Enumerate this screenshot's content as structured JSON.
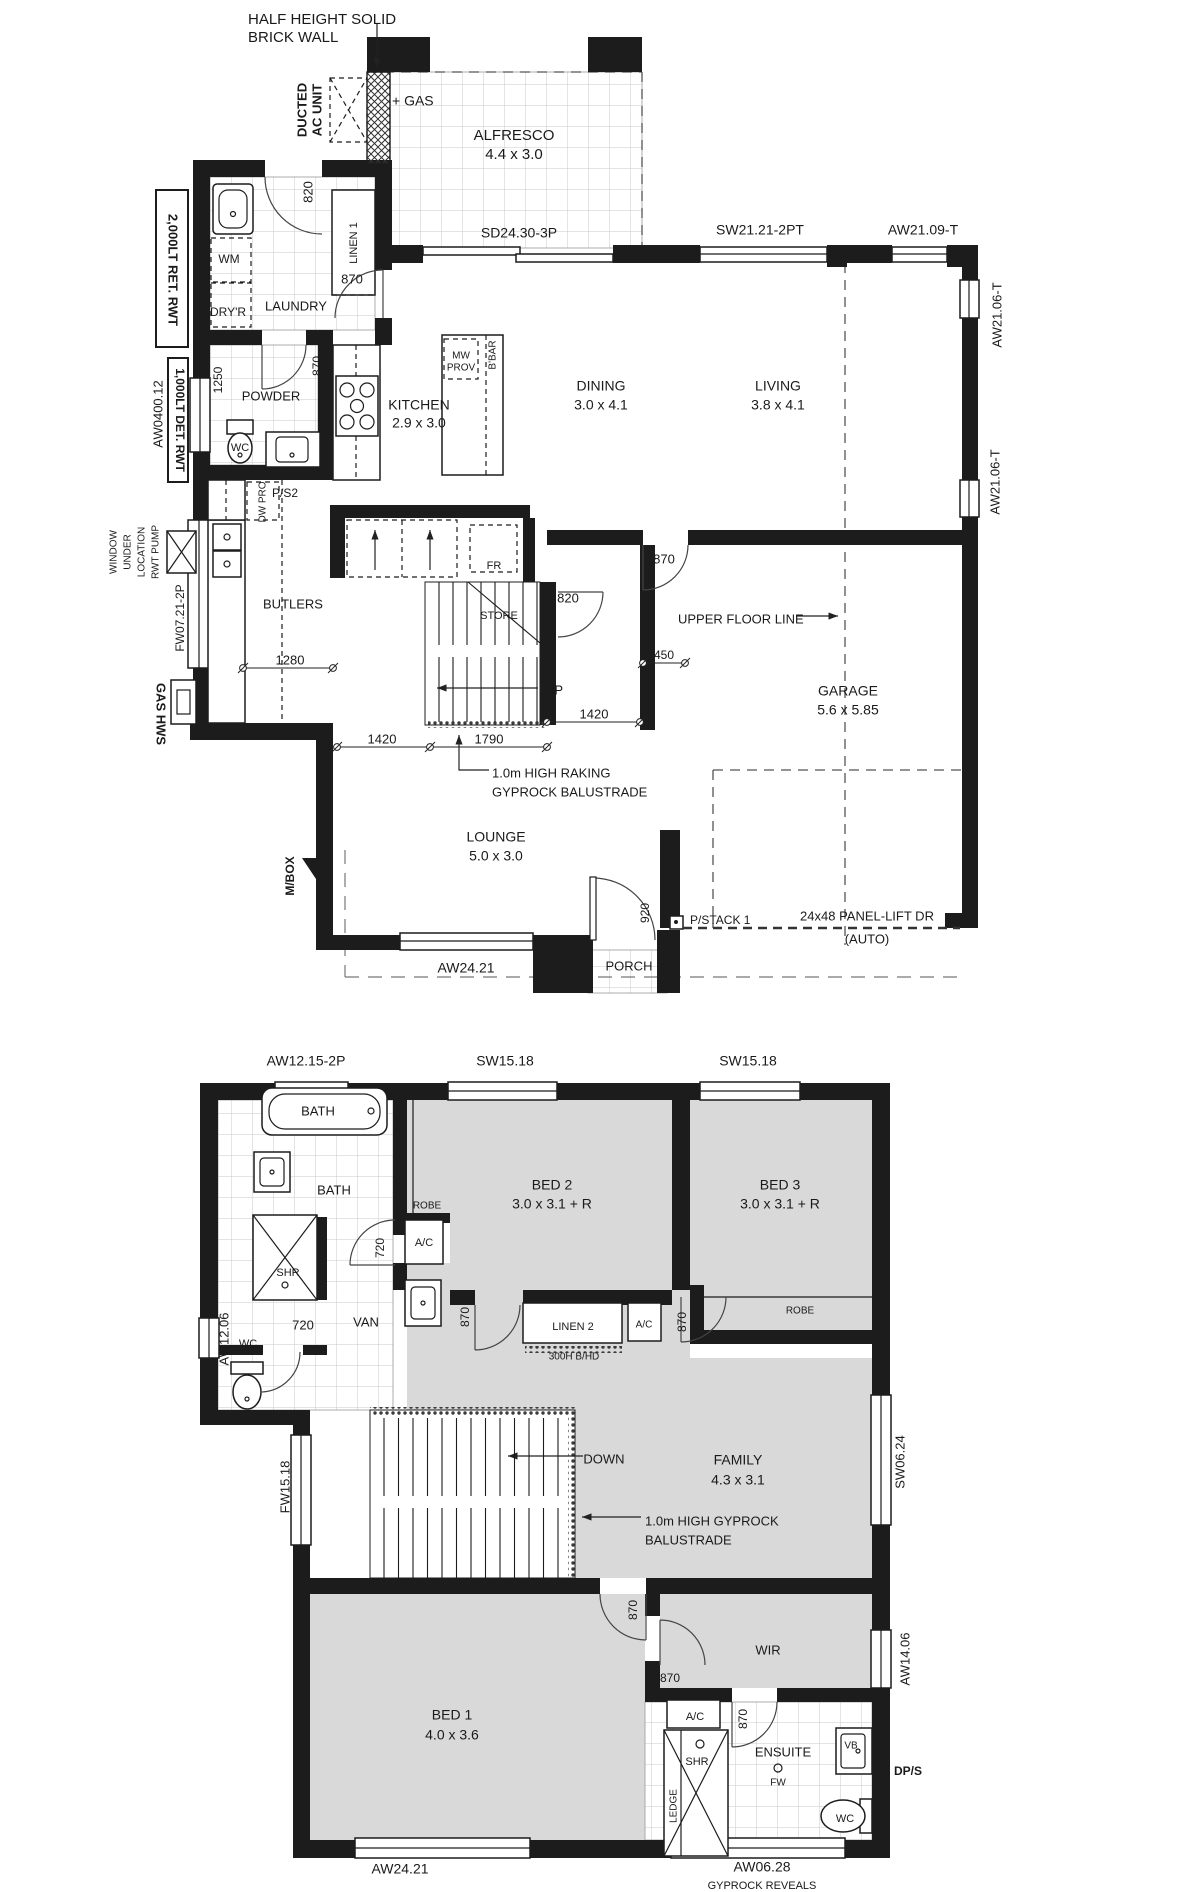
{
  "colors": {
    "wall": "#1c1c1c",
    "carpet": "#d9d9d9",
    "tile_line": "#c9c9c9",
    "paper": "#ffffff"
  },
  "ground_floor": {
    "labels": [
      {
        "t": "HALF HEIGHT SOLID",
        "x": 248,
        "y": 20,
        "a": "start",
        "s": 15
      },
      {
        "t": "BRICK WALL",
        "x": 248,
        "y": 38,
        "a": "start",
        "s": 15
      },
      {
        "t": "DUCTED",
        "x": 303,
        "y": 110,
        "r": -90,
        "s": 13,
        "b": 1
      },
      {
        "t": "AC UNIT",
        "x": 318,
        "y": 110,
        "r": -90,
        "s": 13,
        "b": 1
      },
      {
        "t": "+ GAS",
        "x": 392,
        "y": 102,
        "a": "start",
        "s": 14
      },
      {
        "t": "ALFRESCO",
        "x": 514,
        "y": 136,
        "s": 15
      },
      {
        "t": "4.4 x 3.0",
        "x": 514,
        "y": 155,
        "s": 15
      },
      {
        "t": "SD24.30-3P",
        "x": 519,
        "y": 234,
        "s": 14
      },
      {
        "t": "SW21.21-2PT",
        "x": 760,
        "y": 231,
        "s": 14
      },
      {
        "t": "AW21.09-T",
        "x": 923,
        "y": 231,
        "s": 14
      },
      {
        "t": "AW21.06-T",
        "x": 998,
        "y": 315,
        "r": -90,
        "s": 13
      },
      {
        "t": "AW21.06-T",
        "x": 996,
        "y": 482,
        "r": -90,
        "s": 13
      },
      {
        "t": "2,000LT RET. RWT",
        "x": 172,
        "y": 270,
        "r": 90,
        "s": 13,
        "b": 1
      },
      {
        "t": "820",
        "x": 309,
        "y": 192,
        "r": -90,
        "s": 13
      },
      {
        "t": "LINEN 1",
        "x": 354,
        "y": 243,
        "r": -90,
        "s": 11
      },
      {
        "t": "WM",
        "x": 229,
        "y": 260,
        "s": 12
      },
      {
        "t": "DRY'R",
        "x": 228,
        "y": 313,
        "s": 12
      },
      {
        "t": "LAUNDRY",
        "x": 296,
        "y": 307,
        "s": 13
      },
      {
        "t": "870",
        "x": 352,
        "y": 280,
        "s": 13
      },
      {
        "t": "1250",
        "x": 219,
        "y": 380,
        "r": -90,
        "s": 12
      },
      {
        "t": "POWDER",
        "x": 271,
        "y": 397,
        "s": 13
      },
      {
        "t": "870",
        "x": 318,
        "y": 366,
        "r": -90,
        "s": 12
      },
      {
        "t": "WC",
        "x": 240,
        "y": 448,
        "s": 11
      },
      {
        "t": "AW0400.12",
        "x": 159,
        "y": 414,
        "r": -90,
        "s": 13
      },
      {
        "t": "1,000LT DET. RWT",
        "x": 179,
        "y": 420,
        "r": 90,
        "s": 12,
        "b": 1
      },
      {
        "t": "KITCHEN",
        "x": 419,
        "y": 406,
        "s": 14
      },
      {
        "t": "2.9 x 3.0",
        "x": 419,
        "y": 424,
        "s": 14
      },
      {
        "t": "MW",
        "x": 461,
        "y": 356,
        "s": 10
      },
      {
        "t": "PROV",
        "x": 461,
        "y": 368,
        "s": 10
      },
      {
        "t": "B'BAR",
        "x": 493,
        "y": 355,
        "r": -90,
        "s": 10
      },
      {
        "t": "DINING",
        "x": 601,
        "y": 387,
        "s": 14
      },
      {
        "t": "3.0 x 4.1",
        "x": 601,
        "y": 406,
        "s": 14
      },
      {
        "t": "LIVING",
        "x": 778,
        "y": 387,
        "s": 14
      },
      {
        "t": "3.8 x 4.1",
        "x": 778,
        "y": 406,
        "s": 14
      },
      {
        "t": "P/S2",
        "x": 272,
        "y": 494,
        "a": "start",
        "s": 12
      },
      {
        "t": "DW PRO",
        "x": 263,
        "y": 502,
        "r": -90,
        "s": 10
      },
      {
        "t": "RWT PUMP",
        "x": 156,
        "y": 552,
        "r": -90,
        "s": 10
      },
      {
        "t": "LOCATION",
        "x": 142,
        "y": 552,
        "r": -90,
        "s": 10
      },
      {
        "t": "UNDER",
        "x": 128,
        "y": 552,
        "r": -90,
        "s": 10
      },
      {
        "t": "WINDOW",
        "x": 114,
        "y": 552,
        "r": -90,
        "s": 10
      },
      {
        "t": "FW07.21-2P",
        "x": 181,
        "y": 618,
        "r": -90,
        "s": 12
      },
      {
        "t": "BUTLERS",
        "x": 293,
        "y": 605,
        "s": 13
      },
      {
        "t": "1280",
        "x": 290,
        "y": 661,
        "s": 13
      },
      {
        "t": "GAS HWS",
        "x": 160,
        "y": 714,
        "r": 90,
        "s": 13,
        "b": 1
      },
      {
        "t": "FR",
        "x": 494,
        "y": 566,
        "s": 11
      },
      {
        "t": "STORE",
        "x": 499,
        "y": 616,
        "s": 11
      },
      {
        "t": "820",
        "x": 568,
        "y": 599,
        "s": 13
      },
      {
        "t": "870",
        "x": 664,
        "y": 560,
        "s": 13
      },
      {
        "t": "UPPER FLOOR LINE",
        "x": 678,
        "y": 620,
        "a": "start",
        "s": 13
      },
      {
        "t": "450",
        "x": 664,
        "y": 656,
        "s": 12
      },
      {
        "t": "GARAGE",
        "x": 848,
        "y": 692,
        "s": 14
      },
      {
        "t": "5.6 x 5.85",
        "x": 848,
        "y": 711,
        "s": 14
      },
      {
        "t": "UP",
        "x": 545,
        "y": 691,
        "a": "start",
        "s": 13
      },
      {
        "t": "1420",
        "x": 594,
        "y": 715,
        "s": 13
      },
      {
        "t": "1420",
        "x": 382,
        "y": 740,
        "s": 13
      },
      {
        "t": "1790",
        "x": 489,
        "y": 740,
        "s": 13
      },
      {
        "t": "1.0m HIGH RAKING",
        "x": 492,
        "y": 774,
        "a": "start",
        "s": 13
      },
      {
        "t": "GYPROCK BALUSTRADE",
        "x": 492,
        "y": 793,
        "a": "start",
        "s": 13
      },
      {
        "t": "LOUNGE",
        "x": 496,
        "y": 838,
        "s": 14
      },
      {
        "t": "5.0 x 3.0",
        "x": 496,
        "y": 857,
        "s": 14
      },
      {
        "t": "M/BOX",
        "x": 291,
        "y": 876,
        "r": -90,
        "s": 12,
        "b": 1
      },
      {
        "t": "920",
        "x": 646,
        "y": 913,
        "r": -90,
        "s": 12
      },
      {
        "t": "P/STACK 1",
        "x": 690,
        "y": 921,
        "a": "start",
        "s": 12
      },
      {
        "t": "24x48 PANEL-LIFT DR",
        "x": 867,
        "y": 917,
        "s": 13
      },
      {
        "t": "(AUTO)",
        "x": 867,
        "y": 940,
        "s": 13
      },
      {
        "t": "AW24.21",
        "x": 466,
        "y": 969,
        "s": 14
      },
      {
        "t": "PORCH",
        "x": 629,
        "y": 967,
        "s": 13
      }
    ]
  },
  "upper_floor": {
    "labels": [
      {
        "t": "AW12.15-2P",
        "x": 306,
        "y": 1062,
        "s": 14
      },
      {
        "t": "SW15.18",
        "x": 505,
        "y": 1062,
        "s": 14
      },
      {
        "t": "SW15.18",
        "x": 748,
        "y": 1062,
        "s": 14
      },
      {
        "t": "BATH",
        "x": 318,
        "y": 1112,
        "s": 13
      },
      {
        "t": "BATH",
        "x": 334,
        "y": 1191,
        "s": 13
      },
      {
        "t": "ROBE",
        "x": 427,
        "y": 1206,
        "s": 10
      },
      {
        "t": "BED 2",
        "x": 552,
        "y": 1186,
        "s": 14
      },
      {
        "t": "3.0 x 3.1 + R",
        "x": 552,
        "y": 1205,
        "s": 14
      },
      {
        "t": "BED 3",
        "x": 780,
        "y": 1186,
        "s": 14
      },
      {
        "t": "3.0 x 3.1 + R",
        "x": 780,
        "y": 1205,
        "s": 14
      },
      {
        "t": "A/C",
        "x": 424,
        "y": 1243,
        "s": 11
      },
      {
        "t": "720",
        "x": 381,
        "y": 1248,
        "r": -90,
        "s": 12
      },
      {
        "t": "SHR",
        "x": 288,
        "y": 1273,
        "s": 11
      },
      {
        "t": "720",
        "x": 303,
        "y": 1326,
        "s": 13
      },
      {
        "t": "VAN",
        "x": 366,
        "y": 1323,
        "s": 13
      },
      {
        "t": "870",
        "x": 466,
        "y": 1317,
        "r": -90,
        "s": 12
      },
      {
        "t": "WC",
        "x": 248,
        "y": 1344,
        "s": 11
      },
      {
        "t": "AW12.06",
        "x": 225,
        "y": 1339,
        "r": -90,
        "s": 13
      },
      {
        "t": "LINEN 2",
        "x": 573,
        "y": 1327,
        "s": 11
      },
      {
        "t": "A/C",
        "x": 644,
        "y": 1325,
        "s": 10
      },
      {
        "t": "300H B/HD",
        "x": 574,
        "y": 1357,
        "s": 10
      },
      {
        "t": "ROBE",
        "x": 800,
        "y": 1311,
        "s": 10
      },
      {
        "t": "870",
        "x": 683,
        "y": 1322,
        "r": -90,
        "s": 12
      },
      {
        "t": "FW15.18",
        "x": 286,
        "y": 1487,
        "r": -90,
        "s": 13
      },
      {
        "t": "DOWN",
        "x": 604,
        "y": 1460,
        "s": 13
      },
      {
        "t": "FAMILY",
        "x": 738,
        "y": 1461,
        "s": 14
      },
      {
        "t": "4.3 x 3.1",
        "x": 738,
        "y": 1481,
        "s": 14
      },
      {
        "t": "SW06.24",
        "x": 901,
        "y": 1462,
        "r": -90,
        "s": 13
      },
      {
        "t": "1.0m HIGH GYPROCK",
        "x": 645,
        "y": 1522,
        "a": "start",
        "s": 13
      },
      {
        "t": "BALUSTRADE",
        "x": 645,
        "y": 1541,
        "a": "start",
        "s": 13
      },
      {
        "t": "870",
        "x": 634,
        "y": 1610,
        "r": -90,
        "s": 12
      },
      {
        "t": "WIR",
        "x": 768,
        "y": 1651,
        "s": 13
      },
      {
        "t": "AW14.06",
        "x": 906,
        "y": 1659,
        "r": -90,
        "s": 13
      },
      {
        "t": "870",
        "x": 670,
        "y": 1679,
        "s": 12
      },
      {
        "t": "BED 1",
        "x": 452,
        "y": 1716,
        "s": 14
      },
      {
        "t": "4.0 x 3.6",
        "x": 452,
        "y": 1736,
        "s": 14
      },
      {
        "t": "A/C",
        "x": 695,
        "y": 1717,
        "s": 11
      },
      {
        "t": "870",
        "x": 744,
        "y": 1719,
        "r": -90,
        "s": 12
      },
      {
        "t": "ENSUITE",
        "x": 783,
        "y": 1753,
        "s": 13
      },
      {
        "t": "SHR",
        "x": 697,
        "y": 1762,
        "s": 11
      },
      {
        "t": "FW",
        "x": 778,
        "y": 1783,
        "s": 10
      },
      {
        "t": "VB",
        "x": 851,
        "y": 1746,
        "s": 10
      },
      {
        "t": "LEDGE",
        "x": 674,
        "y": 1806,
        "r": -90,
        "s": 10
      },
      {
        "t": "WC",
        "x": 845,
        "y": 1819,
        "s": 11
      },
      {
        "t": "DP/S",
        "x": 908,
        "y": 1772,
        "s": 12,
        "b": 1
      },
      {
        "t": "AW24.21",
        "x": 400,
        "y": 1870,
        "s": 14
      },
      {
        "t": "AW06.28",
        "x": 762,
        "y": 1868,
        "s": 14
      },
      {
        "t": "GYPROCK REVEALS",
        "x": 762,
        "y": 1886,
        "s": 11
      }
    ]
  }
}
